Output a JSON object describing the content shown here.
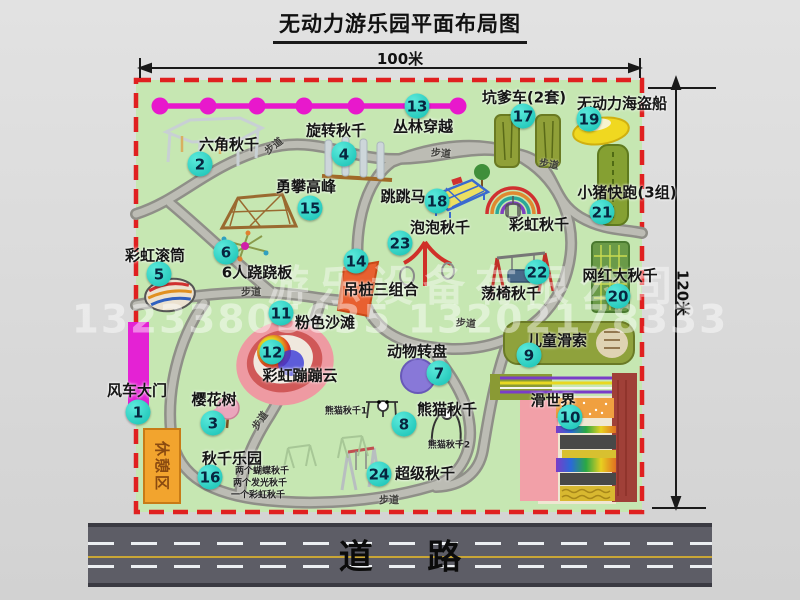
{
  "page": {
    "title": "无动力游乐园平面布局图"
  },
  "dimensions": {
    "width_label": "100米",
    "height_label": "120米"
  },
  "road": {
    "label": "道路"
  },
  "watermark": {
    "company": "游乐设备有限公司",
    "phone": "13233805635 13202178333"
  },
  "rest_area": {
    "label": "休憩区"
  },
  "walkway": {
    "label": "步道",
    "positions": [
      {
        "x": 273,
        "y": 145,
        "r": -38
      },
      {
        "x": 441,
        "y": 152,
        "r": 5
      },
      {
        "x": 549,
        "y": 163,
        "r": 10
      },
      {
        "x": 251,
        "y": 291,
        "r": 0
      },
      {
        "x": 466,
        "y": 322,
        "r": 5
      },
      {
        "x": 259,
        "y": 420,
        "r": -55
      },
      {
        "x": 389,
        "y": 499,
        "r": 0
      }
    ]
  },
  "attractions": [
    {
      "num": "1",
      "name": "风车大门",
      "cx": 138,
      "cy": 412,
      "lx": 137,
      "ly": 390
    },
    {
      "num": "2",
      "name": "六角秋千",
      "cx": 200,
      "cy": 164,
      "lx": 229,
      "ly": 144
    },
    {
      "num": "3",
      "name": "樱花树",
      "cx": 213,
      "cy": 423,
      "lx": 214,
      "ly": 399
    },
    {
      "num": "4",
      "name": "旋转秋千",
      "cx": 344,
      "cy": 154,
      "lx": 336,
      "ly": 130
    },
    {
      "num": "5",
      "name": "彩虹滚筒",
      "cx": 159,
      "cy": 274,
      "lx": 155,
      "ly": 255
    },
    {
      "num": "6",
      "name": "6人跷跷板",
      "cx": 226,
      "cy": 252,
      "lx": 257,
      "ly": 272
    },
    {
      "num": "7",
      "name": "动物转盘",
      "cx": 439,
      "cy": 373,
      "lx": 417,
      "ly": 351
    },
    {
      "num": "8",
      "name": "熊猫秋千",
      "cx": 404,
      "cy": 424,
      "lx": 447,
      "ly": 409,
      "notes": [
        {
          "text": "熊猫秋千1",
          "x": 346,
          "y": 410
        },
        {
          "text": "熊猫秋千2",
          "x": 449,
          "y": 444
        }
      ]
    },
    {
      "num": "9",
      "name": "儿童滑索",
      "cx": 529,
      "cy": 355,
      "lx": 557,
      "ly": 340
    },
    {
      "num": "10",
      "name": "滑世界",
      "cx": 570,
      "cy": 417,
      "lx": 553,
      "ly": 400
    },
    {
      "num": "11",
      "name": "粉色沙滩",
      "cx": 281,
      "cy": 313,
      "lx": 325,
      "ly": 322
    },
    {
      "num": "12",
      "name": "彩虹蹦蹦云",
      "cx": 272,
      "cy": 352,
      "lx": 300,
      "ly": 375
    },
    {
      "num": "13",
      "name": "丛林穿越",
      "cx": 417,
      "cy": 106,
      "lx": 423,
      "ly": 126
    },
    {
      "num": "14",
      "name": "吊桩三组合",
      "cx": 356,
      "cy": 261,
      "lx": 381,
      "ly": 289
    },
    {
      "num": "15",
      "name": "勇攀高峰",
      "cx": 310,
      "cy": 208,
      "lx": 306,
      "ly": 186
    },
    {
      "num": "16",
      "name": "秋千乐园",
      "cx": 210,
      "cy": 477,
      "lx": 232,
      "ly": 458,
      "notes": [
        {
          "text": "两个蝴蝶秋千",
          "x": 262,
          "y": 470
        },
        {
          "text": "两个发光秋千",
          "x": 260,
          "y": 482
        },
        {
          "text": "一个彩虹秋千",
          "x": 258,
          "y": 494
        }
      ]
    },
    {
      "num": "17",
      "name": "坑爹车(2套)",
      "cx": 523,
      "cy": 116,
      "lx": 524,
      "ly": 97
    },
    {
      "num": "18",
      "name": "跳跳马",
      "cx": 437,
      "cy": 201,
      "lx": 403,
      "ly": 196
    },
    {
      "num": "19",
      "name": "无动力海盗船",
      "cx": 589,
      "cy": 119,
      "lx": 622,
      "ly": 103
    },
    {
      "num": "20",
      "name": "网红大秋千",
      "cx": 618,
      "cy": 296,
      "lx": 620,
      "ly": 275
    },
    {
      "num": "21",
      "name": "小猪快跑(3组)",
      "cx": 602,
      "cy": 212,
      "lx": 627,
      "ly": 192
    },
    {
      "num": "22",
      "name": "荡椅秋千",
      "cx": 537,
      "cy": 272,
      "lx": 511,
      "ly": 293
    },
    {
      "num": "23",
      "name": "泡泡秋千",
      "cx": 400,
      "cy": 243,
      "lx": 440,
      "ly": 227
    },
    {
      "num": "24",
      "name": "超级秋千",
      "cx": 379,
      "cy": 474,
      "lx": 425,
      "ly": 473
    },
    {
      "num": "",
      "name": "彩虹秋千",
      "cx": 0,
      "cy": 0,
      "lx": 539,
      "ly": 224
    }
  ],
  "colors": {
    "park_green": "#c6e7b2",
    "border_red": "#e02020",
    "path_gray": "#8f8f88",
    "zipline_magenta": "#e818cc",
    "marker_teal": "#14bfb2",
    "gate_magenta": "#e422d4",
    "rest_orange": "#f2a42e",
    "road_gray": "#5d5d66"
  }
}
